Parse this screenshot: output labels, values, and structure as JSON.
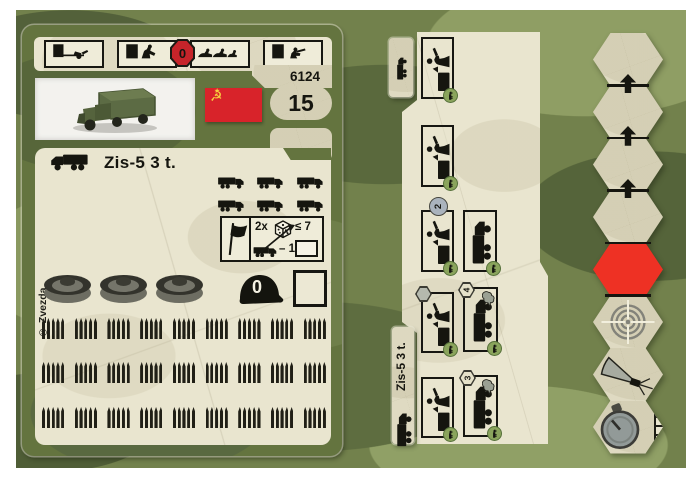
{
  "palette": {
    "camo_base": "#72814c",
    "camo_dark": "#53613a",
    "camo_light": "#8f9e64",
    "card_green": "#64743f",
    "paper": "#e9e5cf",
    "flag_red": "#d8232a",
    "hex_red": "#ee3124",
    "ink": "#15150f",
    "dot_green": "#8aa45c"
  },
  "left_card": {
    "set_number": "6124",
    "points": "15",
    "title": "Zis-5 3 t.",
    "copyright": "© Zvezda",
    "flag": {
      "name": "soviet-flag",
      "emblem": "☭",
      "star": "★"
    },
    "header_actions": [
      {
        "icon": "tow-icon",
        "label": "tow"
      },
      {
        "icon": "push-icon",
        "label": "push"
      },
      {
        "icon": "crawl-icon",
        "label": "crawl",
        "badge": "0"
      },
      {
        "icon": "cover-icon",
        "label": "take-cover"
      }
    ],
    "transport_capacity": {
      "icon": "truck-icon",
      "count": 6
    },
    "combat_table": {
      "flag_icon": "flag-icon",
      "multiplier": "2x",
      "dice_icon": "dice-icon",
      "threshold": "≤ 7",
      "modifier_icon": "truck-icon",
      "modifier": "– 1"
    },
    "damage_tokens": {
      "icon": "wheel-token",
      "count": 3
    },
    "helmet": {
      "icon": "helmet-icon",
      "value": "0"
    },
    "ammo_track": {
      "rows": 3,
      "groups_per_row": 9,
      "rounds_per_group": 5
    }
  },
  "right_card": {
    "tab_title": "Zis-5 3 t.",
    "tab_icon": "truck-icon",
    "corner_dot_icon": "truck-icon",
    "action_boxes": [
      {
        "id": 1,
        "icon": "load-icon"
      },
      {
        "id": 2,
        "icon": "load-icon"
      },
      {
        "id": 3,
        "icon": "load-icon",
        "badge": {
          "shape": "circle",
          "value": "2"
        }
      },
      {
        "id": 4,
        "icon": "truck-icon"
      },
      {
        "id": 5,
        "icon": "load-icon",
        "badge": {
          "shape": "hex",
          "value": ""
        }
      },
      {
        "id": 6,
        "icon": "truck-icon",
        "smoke": true,
        "badge": {
          "shape": "hex",
          "value": "4"
        }
      },
      {
        "id": 7,
        "icon": "load-icon"
      },
      {
        "id": 8,
        "icon": "truck-icon",
        "smoke": true,
        "badge": {
          "shape": "hex",
          "value": "3"
        }
      }
    ],
    "hex_track": {
      "movement_hexes": 4,
      "movement_arrows": 3,
      "special_hexes": [
        "red",
        "target",
        "fire-arc",
        "timer"
      ],
      "timer_boxes": 4
    }
  }
}
